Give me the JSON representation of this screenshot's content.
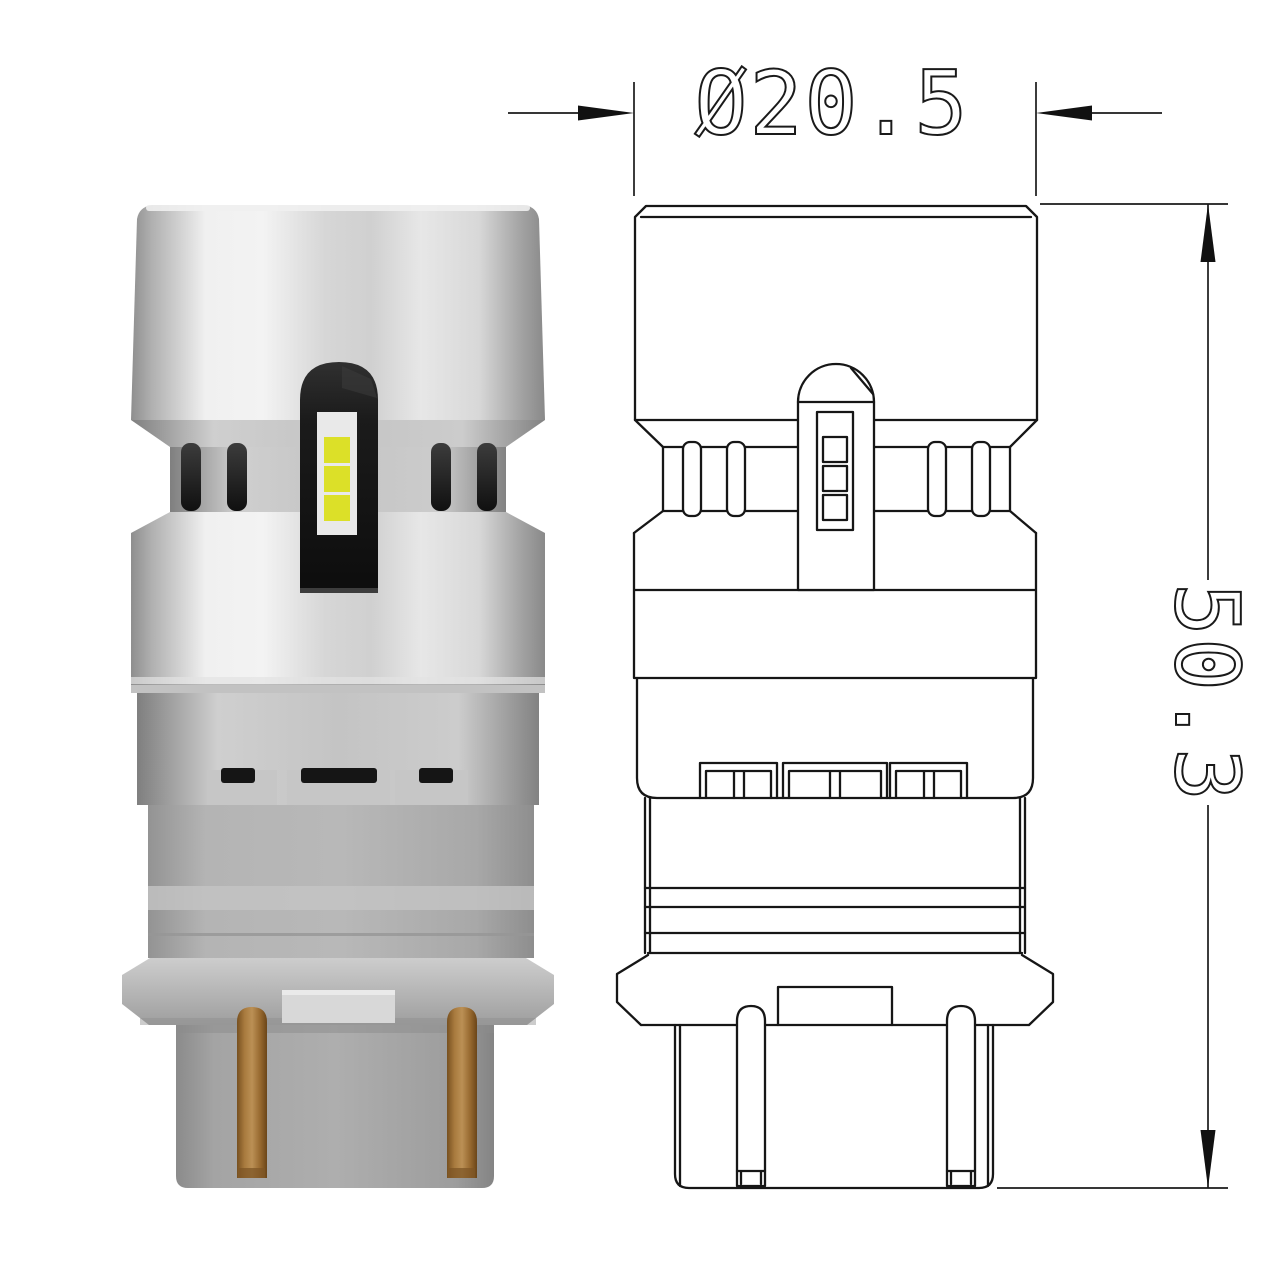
{
  "dimensions": {
    "diameter": "Ø20.5",
    "height": "50.3"
  },
  "specs": {
    "led_chip_count": 3,
    "contact_pin_count": 2,
    "vent_slot_count": 4,
    "base_tab_count": 3
  },
  "colors": {
    "background": "#ffffff",
    "drawing_line": "#161616",
    "metal_silver": "#d9d9d9",
    "metal_edge": "#8e8e8e",
    "plastic_gray": "#afafaf",
    "led_strip_black": "#1a1a1a",
    "led_window_white": "#e9e9e9",
    "led_chip_yellow": "#dce028",
    "copper_pin": "#a87a3e",
    "flange_gray": "#b5b5b5"
  }
}
